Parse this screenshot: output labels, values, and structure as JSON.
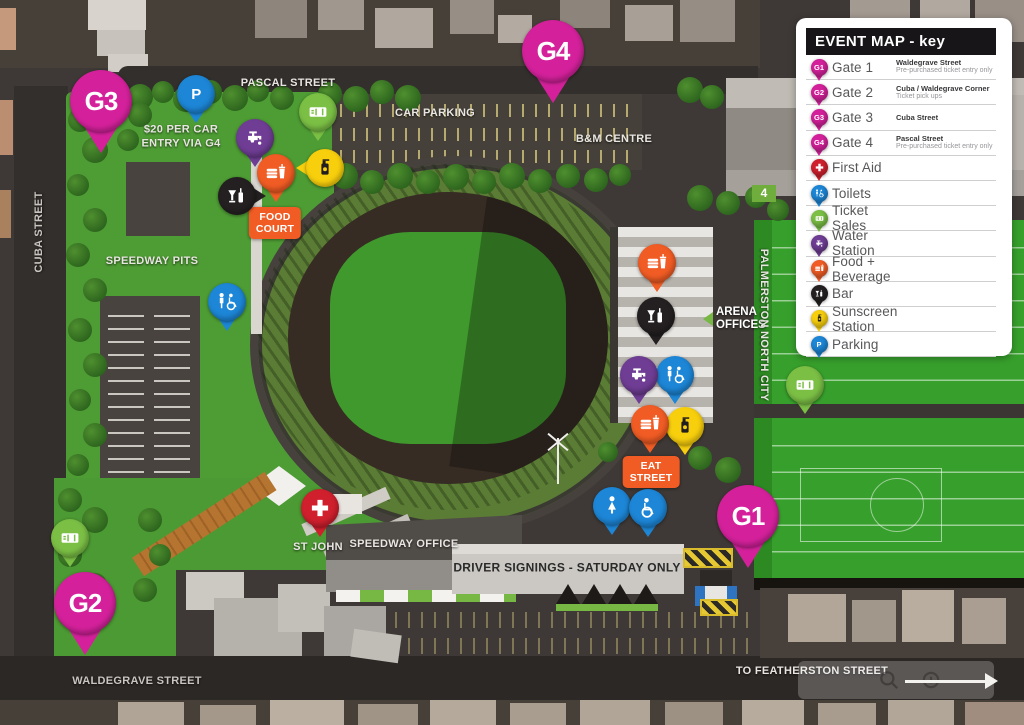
{
  "legend": {
    "title": "EVENT MAP - key",
    "items": [
      {
        "icon": "gate",
        "badge": "G1",
        "label": "Gate 1",
        "sub_title": "Waldegrave Street",
        "sub_text": "Pre-purchased ticket entry only"
      },
      {
        "icon": "gate",
        "badge": "G2",
        "label": "Gate 2",
        "sub_title": "Cuba / Waldegrave Corner",
        "sub_text": "Ticket pick ups"
      },
      {
        "icon": "gate",
        "badge": "G3",
        "label": "Gate 3",
        "sub_title": "Cuba Street",
        "sub_text": ""
      },
      {
        "icon": "gate",
        "badge": "G4",
        "label": "Gate 4",
        "sub_title": "Pascal Street",
        "sub_text": "Pre-purchased ticket entry only"
      },
      {
        "icon": "firstaid",
        "label": "First Aid"
      },
      {
        "icon": "toilets",
        "label": "Toilets"
      },
      {
        "icon": "tickets",
        "label": "Ticket Sales"
      },
      {
        "icon": "water",
        "label": "Water Station"
      },
      {
        "icon": "food",
        "label": "Food + Beverage"
      },
      {
        "icon": "bar",
        "label": "Bar"
      },
      {
        "icon": "sunscreen",
        "label": "Sunscreen Station"
      },
      {
        "icon": "parking",
        "label": "Parking"
      }
    ]
  },
  "pin_colors": {
    "gate": "#d4219b",
    "firstaid": "#d0202e",
    "toilets": "#1d86d6",
    "tickets": "#7bbf45",
    "water": "#6f3d94",
    "food": "#f15c24",
    "bar": "#242021",
    "sunscreen": "#f8cf0d",
    "parking": "#1d86d6",
    "toilet_female": "#1d86d6",
    "toilet_accessible": "#1d86d6"
  },
  "map": {
    "pins": [
      {
        "type": "parking",
        "badge": "P",
        "x": 196,
        "y": 94
      },
      {
        "type": "tickets",
        "x": 318,
        "y": 112
      },
      {
        "type": "water",
        "x": 255,
        "y": 138
      },
      {
        "type": "sunscreen",
        "x": 325,
        "y": 168,
        "dir": "left"
      },
      {
        "type": "bar",
        "x": 237,
        "y": 196,
        "dir": "right"
      },
      {
        "type": "food",
        "x": 276,
        "y": 173
      },
      {
        "type": "toilets",
        "x": 227,
        "y": 302
      },
      {
        "type": "food",
        "x": 657,
        "y": 263
      },
      {
        "type": "bar",
        "x": 656,
        "y": 316
      },
      {
        "type": "toilets",
        "x": 675,
        "y": 375
      },
      {
        "type": "water",
        "x": 639,
        "y": 375
      },
      {
        "type": "sunscreen",
        "x": 685,
        "y": 426
      },
      {
        "type": "food",
        "x": 650,
        "y": 424
      },
      {
        "type": "toilet_female",
        "x": 612,
        "y": 506
      },
      {
        "type": "toilet_accessible",
        "x": 648,
        "y": 508
      },
      {
        "type": "tickets",
        "x": 805,
        "y": 385
      },
      {
        "type": "tickets",
        "x": 70,
        "y": 538
      },
      {
        "type": "firstaid",
        "x": 320,
        "y": 508
      },
      {
        "type": "gate",
        "badge": "G3",
        "x": 101,
        "y": 101,
        "size": "large"
      },
      {
        "type": "gate",
        "badge": "G4",
        "x": 553,
        "y": 51,
        "size": "large"
      },
      {
        "type": "gate",
        "badge": "G2",
        "x": 85,
        "y": 603,
        "size": "large"
      },
      {
        "type": "gate",
        "badge": "G1",
        "x": 748,
        "y": 516,
        "size": "large"
      }
    ],
    "street_labels": [
      {
        "text": "PASCAL STREET",
        "x": 288,
        "y": 84,
        "cls": ""
      },
      {
        "text": "CUBA STREET",
        "x": 40,
        "y": 232,
        "cls": "rot-ccw dim"
      },
      {
        "text": "WALDEGRAVE STREET",
        "x": 137,
        "y": 682,
        "cls": "dim"
      },
      {
        "text": "TO FEATHERSTON STREET",
        "x": 812,
        "y": 672,
        "cls": ""
      },
      {
        "text": "PALMERSTON NORTH CITY",
        "x": 763,
        "y": 325,
        "cls": "rot-cw"
      }
    ],
    "area_labels": [
      {
        "text": "CAR PARKING",
        "x": 435,
        "y": 114,
        "cls": ""
      },
      {
        "text": "B&M CENTRE",
        "x": 614,
        "y": 140,
        "cls": ""
      },
      {
        "text": "SPEEDWAY PITS",
        "x": 152,
        "y": 262,
        "cls": ""
      },
      {
        "text": "SPEEDWAY OFFICE",
        "x": 404,
        "y": 545,
        "cls": ""
      },
      {
        "text": "DRIVER SIGNINGS - SATURDAY ONLY",
        "x": 567,
        "y": 568,
        "cls": "dark"
      },
      {
        "text": "ST JOHN",
        "x": 318,
        "y": 548,
        "cls": ""
      }
    ],
    "notes": [
      {
        "text": "$20 PER CAR\nENTRY VIA G4",
        "x": 181,
        "y": 137
      }
    ],
    "tags": [
      {
        "text": "FOOD\nCOURT",
        "x": 275,
        "y": 223
      },
      {
        "text": "EAT\nSTREET",
        "x": 651,
        "y": 472
      }
    ],
    "arena_offices": {
      "line1": "ARENA",
      "line2": "OFFICES"
    },
    "gate4_sign": "4"
  }
}
